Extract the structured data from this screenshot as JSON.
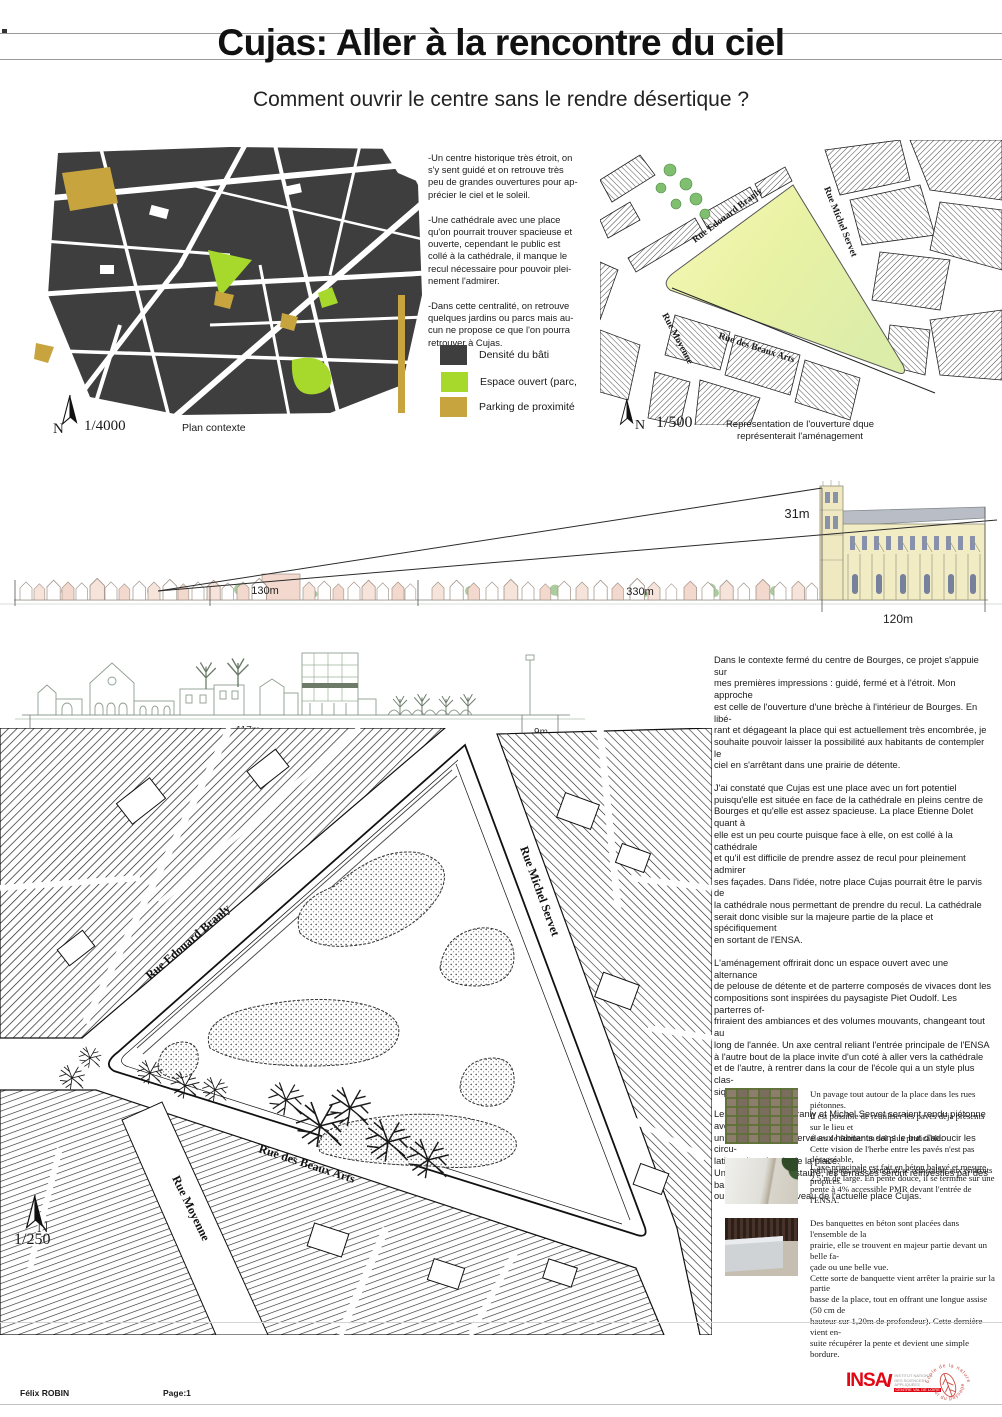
{
  "poster": {
    "title": "Cujas: Aller à la rencontre du ciel",
    "subtitle": "Comment ouvrir le centre sans le rendre désertique ?"
  },
  "streets": {
    "branly": "Rue Edouard Branly",
    "servet": "Rue Michel Servet",
    "beaux_arts": "Rue des Beaux Arts",
    "moyenne": "Rue Moyenne"
  },
  "context_map": {
    "north": "N",
    "scale": "1/4000",
    "caption": "Plan contexte"
  },
  "legend": {
    "items": [
      {
        "label": "Densité du bâti",
        "color": "#3e3e3e"
      },
      {
        "label": "Espace ouvert (parc,",
        "color": "#a6d92c"
      },
      {
        "label": "Parking de proximité",
        "color": "#c8a43e"
      }
    ]
  },
  "intro_notes": [
    "-Un centre historique très étroit, on\ns'y sent guidé et on retrouve très\npeu de grandes ouvertures pour ap-\nprécier le ciel et le soleil.",
    "-Une cathédrale avec une place\nqu'on pourrait trouver spacieuse et\nouverte, cependant le public est\ncollé à la cathédrale, il manque le\nrecul nécessaire pour pouvoir plei-\nnement l'admirer.",
    "-Dans cette centralité, on retrouve\nquelques jardins ou parcs mais au-\ncun ne propose ce que l'on pourra\nretrouver à Cujas."
  ],
  "opening_map": {
    "north": "N",
    "scale": "1/500",
    "caption": "Représentation de l'ouverture dque\nreprésenterait l'aménagement"
  },
  "long_section": {
    "labels": {
      "cathedral_height": "31m",
      "span_left": "130m",
      "span_middle": "330m",
      "span_cathedral": "120m"
    }
  },
  "short_section": {
    "labels": {
      "span_main": "117m",
      "span_end": "9m"
    }
  },
  "main_text": {
    "paragraphs": [
      "Dans le contexte fermé du centre de Bourges, ce projet s'appuie sur\nmes premières impressions : guidé, fermé et à l'étroit. Mon approche\nest celle de l'ouverture d'une brèche à l'intérieur de Bourges. En libé-\nrant et dégageant la place qui est actuellement très encombrée, je\nsouhaite pouvoir laisser la possibilité aux habitants de contempler le\nciel en s'arrêtant dans une prairie de détente.",
      "J'ai constaté que Cujas est une place avec un fort potentiel\npuisqu'elle est située en face de la cathédrale en pleins centre de\nBourges et qu'elle est assez spacieuse. La place Etienne Dolet quant à\nelle est un peu courte puisque face à elle, on est collé à la cathédrale\net qu'il est difficile de prendre assez de recul pour pleinement admirer\nses façades. Dans l'idée, notre place Cujas pourrait être le parvis de\nla cathédrale nous permettant de prendre du recul. La cathédrale\nserait donc visible sur la majeure partie de la place et spécifiquement\nen sortant de l'ENSA.",
      "L'aménagement offrirait donc un espace ouvert avec une alternance\nde pelouse de détente et de parterre composés de vivaces dont les\ncompositions sont inspirées du paysagiste Piet Oudolf. Les parterres of-\nfriraient des ambiances et des volumes mouvants, changeant tout au\nlong de l'année. Un axe central reliant l'entrée principale de l'ENSA\nà l'autre bout de la place invite d'un coté à aller vers la cathédrale\net de l'autre, à rentrer dans la cour de l'école qui a un style plus clas-\nsique et intime.",
      "Les rues Edouard Branly et Michel Servet seraient rendu piétonne avec\nun accès voiture réservé aux habitants dans le but d'adoucir les circu-\nlations des abords de la place.\nUne fois le Cujas restauré, les terrasses seront réinvesties par des bars\nou restaurants au niveau de l'actuelle place Cujas."
    ]
  },
  "master_plan": {
    "north": "N",
    "scale": "1/250"
  },
  "details": [
    {
      "photo": "cobblestone-paving-photo",
      "text": "Un pavage tout autour de la place dans les rues piétonnes.\nIl est possible de réutiliser les pavés déjà présents sur le lieu et\nalors de former un sol plus praticable.\nCette vision de l'herbe entre les pavés n'est pas désagréable,\npetit à petit, elle viendrait se réinstaller aux endroits propices."
    },
    {
      "photo": "concrete-path-photo",
      "text": "L'axe principale est fait en béton balayé et mesure\n2,5 m de large. En pente douce, il se termine sur une\npente à 4% accessible PMR devant l'entrée de l'ENSA."
    },
    {
      "photo": "concrete-bench-photo",
      "text": "Des banquettes en béton sont placées dans l'ensemble de la\nprairie, elle se trouvent en majeur partie devant un belle fa-\nçade ou une belle vue.\nCette sorte de banquette vient arrêter la prairie sur la partie\nbasse de la place, tout en offrant une longue assise (50 cm de\nhauteur sur 1,20m de profondeur). Cette dernière vient en-\nsuite récupérer la pente et devient une simple bordure."
    }
  ],
  "footer": {
    "author": "Félix ROBIN",
    "page": "Page:1",
    "insa": {
      "acronym": "INSA",
      "lines": [
        "INSTITUT NATIONAL",
        "DES SCIENCES",
        "APPLIQUÉES",
        "CENTRE VAL DE LOIRE"
      ]
    },
    "stamp": {
      "arc_top": "École de la nature",
      "arc_bottom": "et du paysage"
    }
  },
  "colors": {
    "built_density": "#3e3e3e",
    "open_space": "#a6d92c",
    "parking": "#c8a43e",
    "place_fill": "#eef2a8",
    "insa_red": "#e30613"
  }
}
